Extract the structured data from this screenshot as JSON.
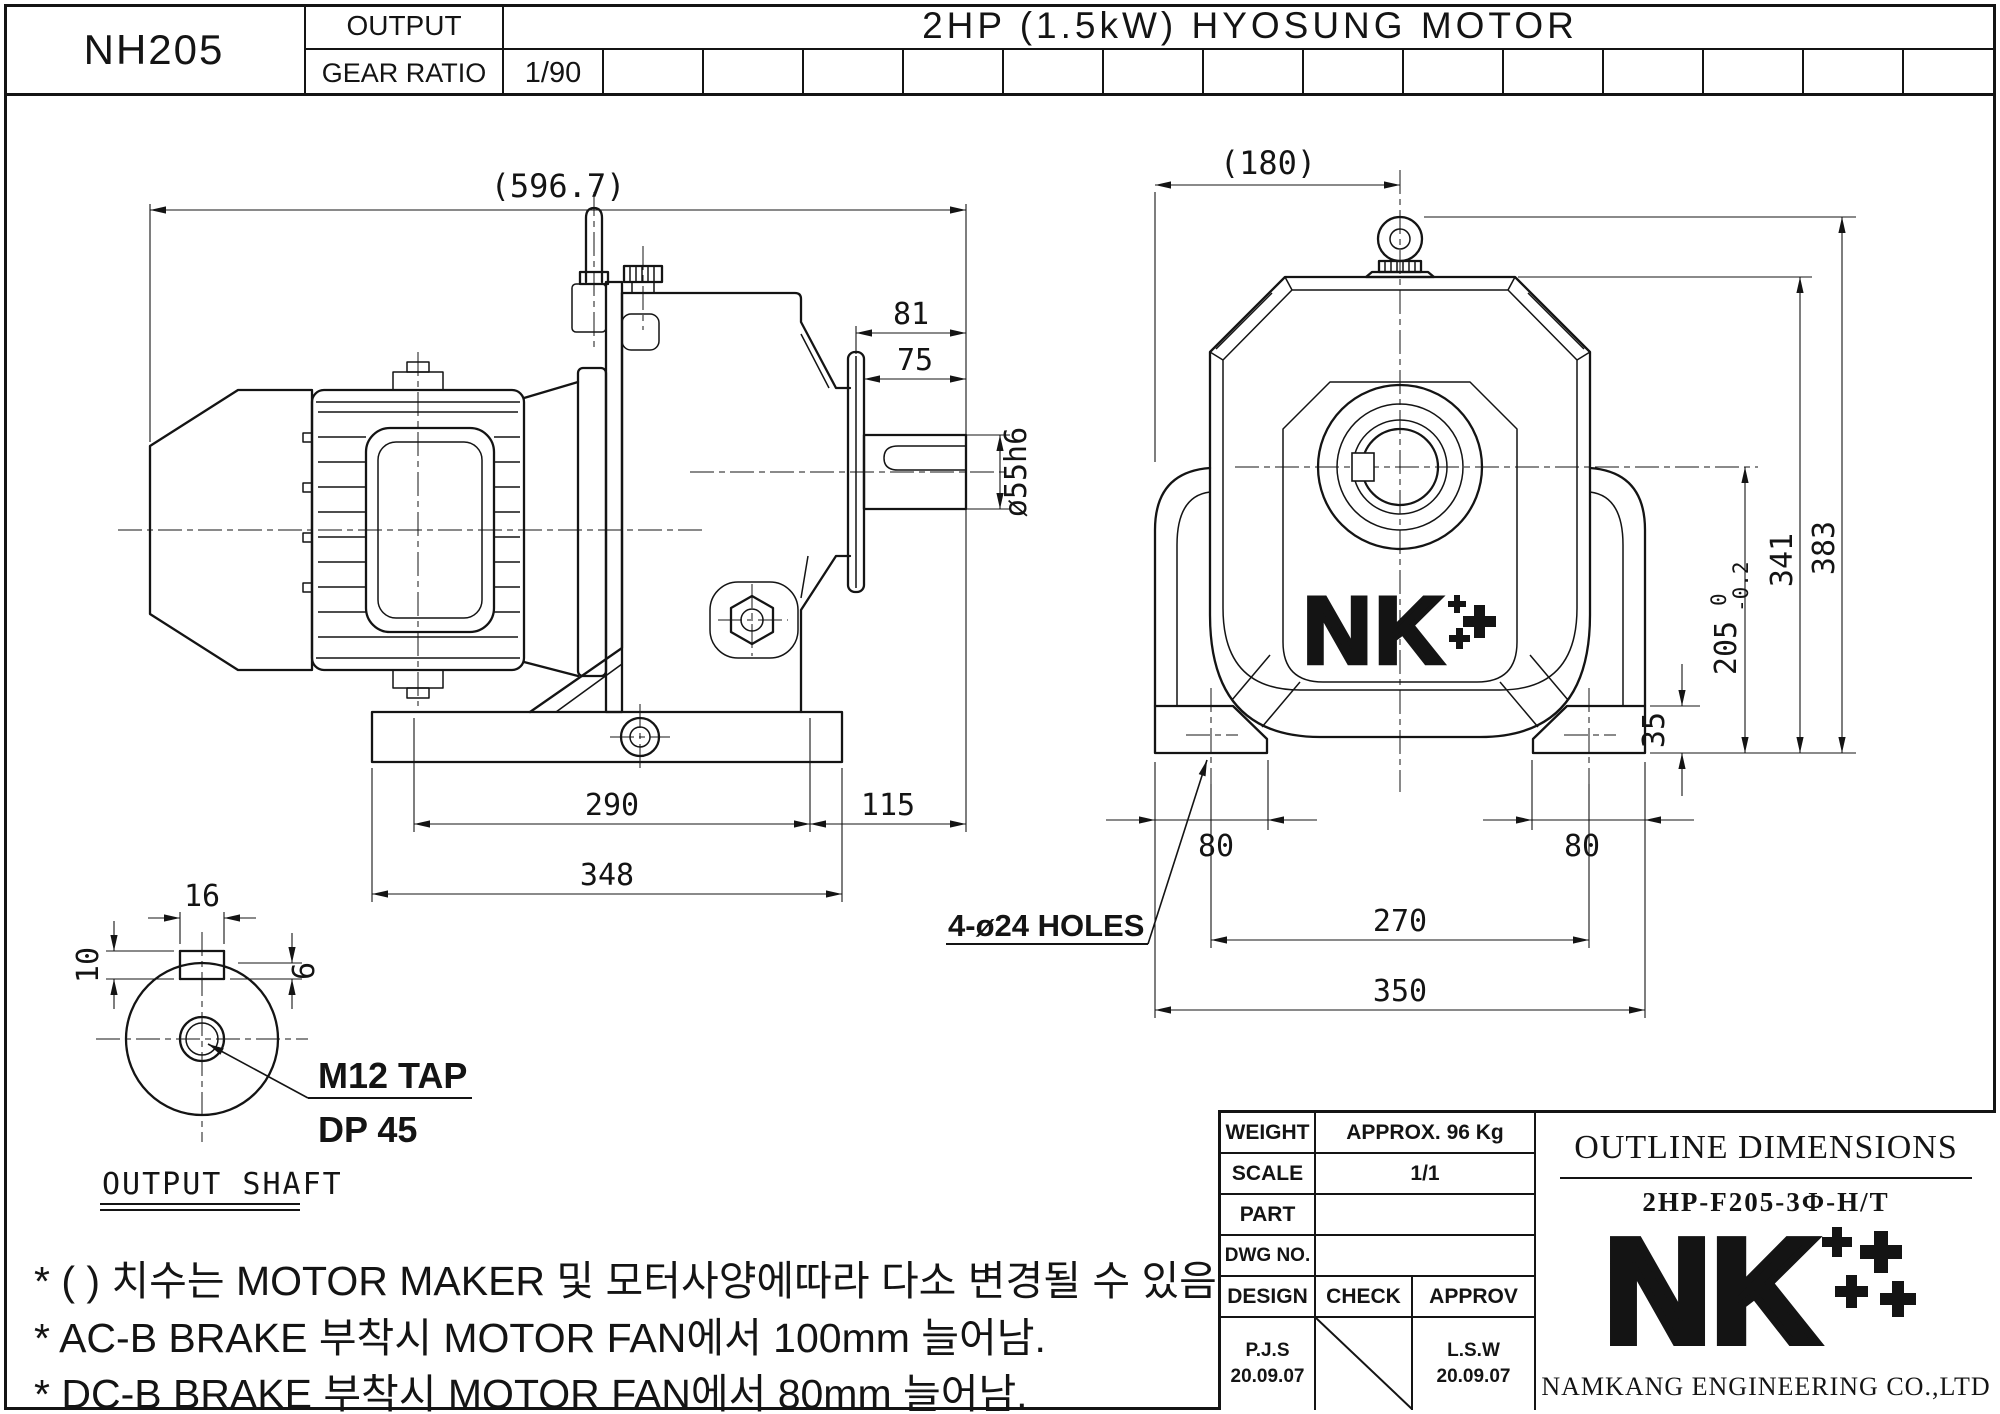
{
  "header": {
    "model": "NH205",
    "output_label": "OUTPUT",
    "gear_ratio_label": "GEAR RATIO",
    "gear_ratio_value": "1/90",
    "motor_title": "2HP (1.5kW) HYOSUNG MOTOR"
  },
  "side_view": {
    "dims": {
      "overall_length": "(596.7)",
      "shaft_ext_total": "81",
      "shaft_length": "75",
      "shaft_dia": "ø55h6",
      "base_span": "290",
      "base_overhang": "115",
      "base_length": "348"
    }
  },
  "front_view": {
    "dims": {
      "width_to_center": "(180)",
      "height_overall": "383",
      "height_housing": "341",
      "height_center": "205",
      "height_center_tol_upper": "0",
      "height_center_tol_lower": "-0.2",
      "foot_height": "35",
      "foot_width_left": "80",
      "foot_width_right": "80",
      "hole_pitch": "270",
      "base_width": "350"
    },
    "holes_note": "4-ø24 HOLES",
    "logo_text": "NK"
  },
  "shaft_detail": {
    "title": "OUTPUT SHAFT",
    "dims": {
      "key_width": "16",
      "key_offset": "10",
      "key_depth": "6"
    },
    "tap_note_line1": "M12 TAP",
    "tap_note_line2": "DP 45"
  },
  "notes": [
    "* (  ) 치수는 MOTOR MAKER 및 모터사양에따라 다소 변경될 수 있음.",
    "* AC-B BRAKE 부착시 MOTOR FAN에서 100mm 늘어남.",
    "* DC-B BRAKE 부착시 MOTOR FAN에서 80mm 늘어남."
  ],
  "title_block": {
    "rows": [
      {
        "label": "WEIGHT",
        "value": "APPROX. 96 Kg"
      },
      {
        "label": "SCALE",
        "value": "1/1"
      },
      {
        "label": "PART",
        "value": ""
      },
      {
        "label": "DWG NO.",
        "value": ""
      }
    ],
    "sign_headers": [
      "DESIGN",
      "CHECK",
      "APPROV"
    ],
    "design_name": "P.J.S",
    "design_date": "20.09.07",
    "approv_name": "L.S.W",
    "approv_date": "20.09.07",
    "doc_title": "OUTLINE DIMENSIONS",
    "doc_code": "2HP-F205-3Φ-H/T",
    "company": "NAMKANG ENGINEERING CO.,LTD",
    "logo_text": "NK"
  },
  "colors": {
    "line": "#141414",
    "background": "#ffffff"
  }
}
